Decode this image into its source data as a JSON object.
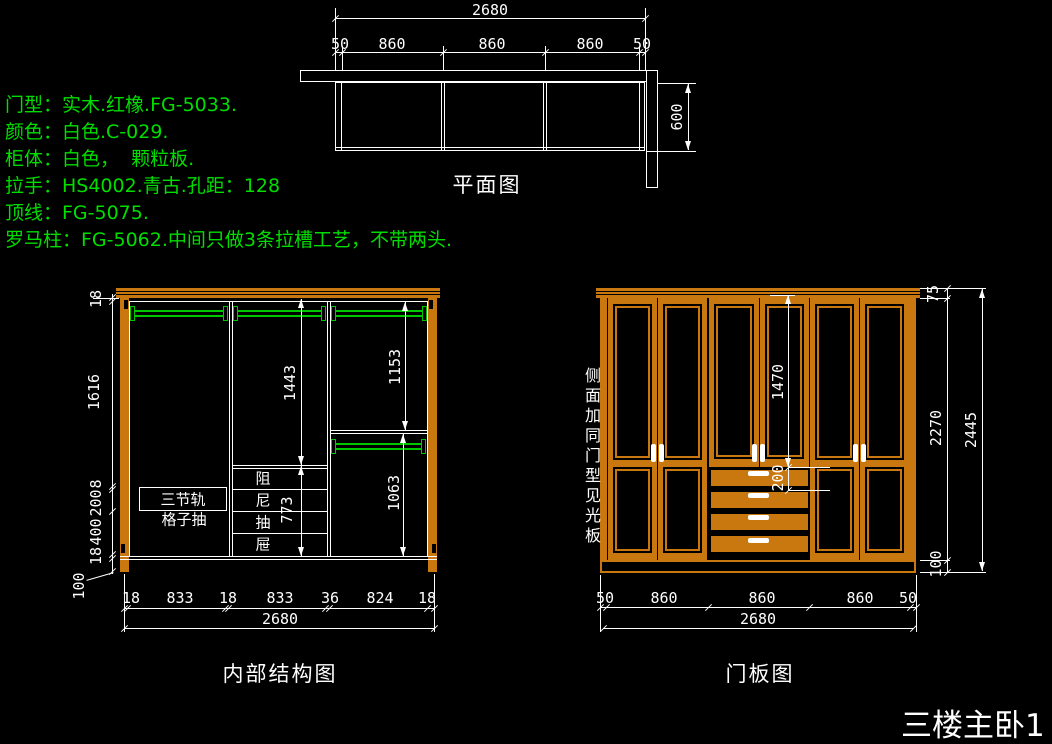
{
  "colors": {
    "background": "#000000",
    "line_white": "#ffffff",
    "annotation_green": "#00de00",
    "rod_green": "#00c800",
    "wood_orange": "#c8780f"
  },
  "specs": {
    "lines": [
      "门型：实木.红橡.FG-5033.",
      "颜色：白色.C-029.",
      "柜体：白色，  颗粒板.",
      "拉手：HS4002.青古.孔距：128",
      "顶线：FG-5075.",
      "罗马柱：FG-5062.中间只做3条拉槽工艺，不带两头."
    ]
  },
  "plan": {
    "title": "平面图",
    "total_width": "2680",
    "segments": [
      "50",
      "860",
      "860",
      "860",
      "50"
    ],
    "depth": "600"
  },
  "internal": {
    "title": "内部结构图",
    "left_dims": [
      "18",
      "1616",
      "8",
      "200",
      "400",
      "18",
      "100"
    ],
    "bottom_dims": [
      "18",
      "833",
      "18",
      "833",
      "36",
      "824",
      "18"
    ],
    "bottom_total": "2680",
    "dim_mid_upper": "1443",
    "dim_right_upper": "1153",
    "dim_drawers": "773",
    "dim_right_lower": "1063",
    "label_rail": "三节轨",
    "label_grid_drawer": "格子抽",
    "damping_chars": [
      "阻",
      "尼",
      "抽",
      "屉"
    ]
  },
  "door": {
    "title": "门板图",
    "side_note": "侧面加同门型见光板",
    "dim_door_height": "1470",
    "dim_drawer_height": "200",
    "dim_crown": "75",
    "dim_body": "2270",
    "dim_plinth": "100",
    "dim_total_height": "2445",
    "bottom_dims": [
      "50",
      "860",
      "860",
      "860",
      "50"
    ],
    "bottom_total": "2680"
  },
  "footer": {
    "drawing_label": "三楼主卧1"
  }
}
